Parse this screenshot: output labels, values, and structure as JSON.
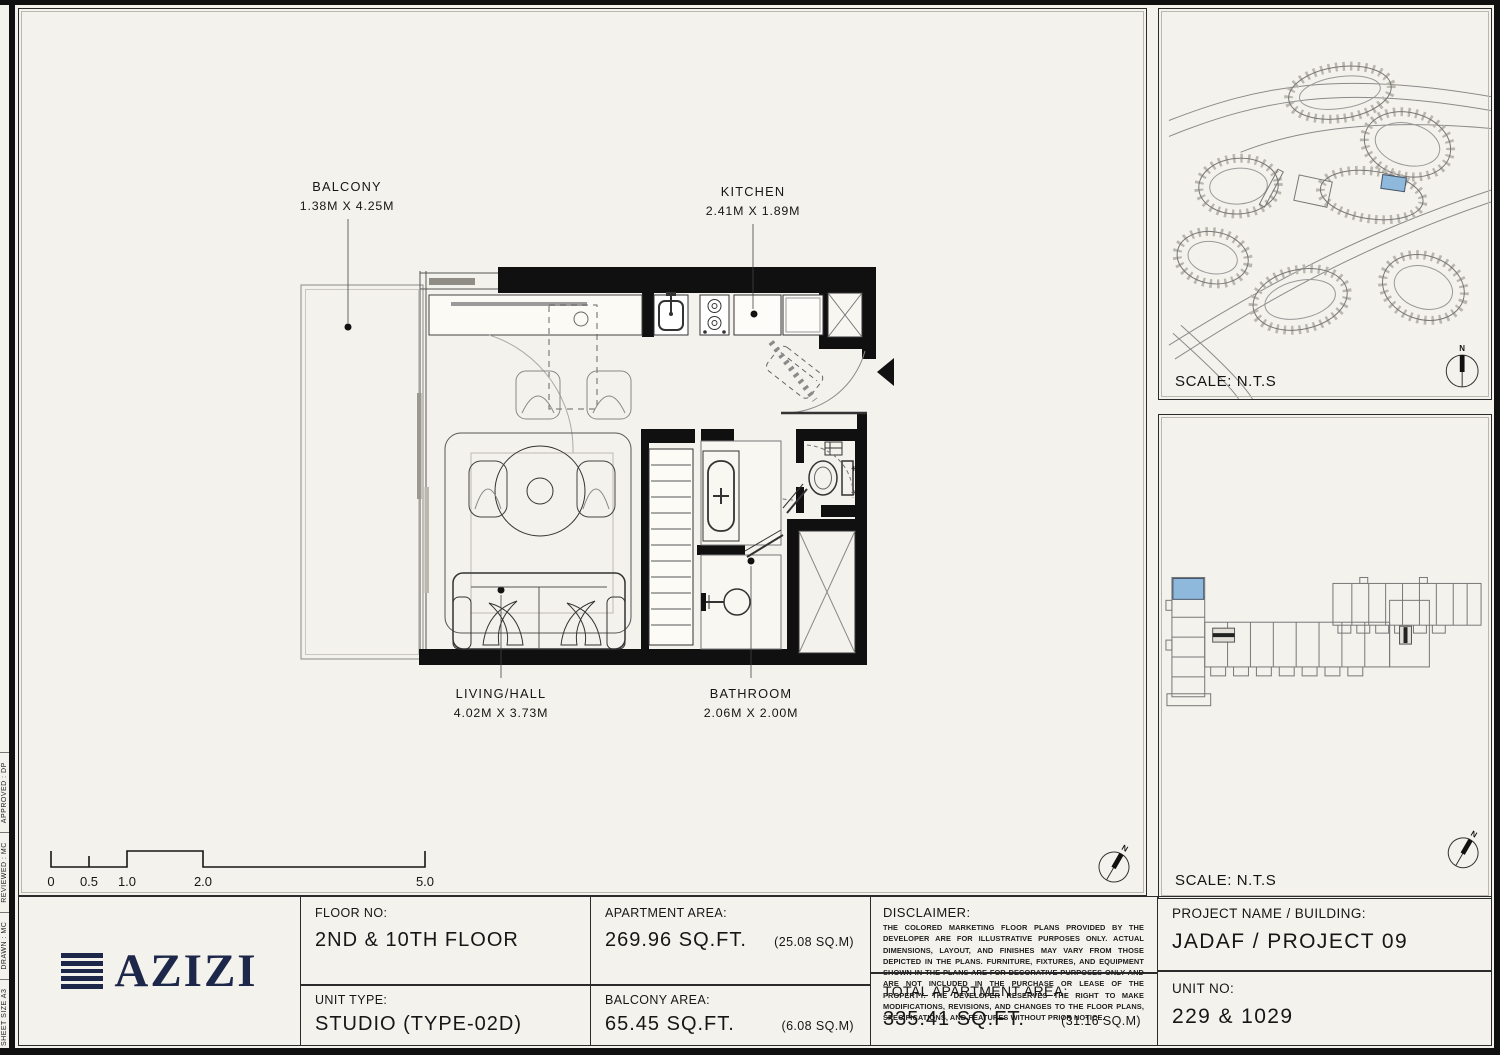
{
  "sheet": {
    "margin_notes": [
      "SHEET SIZE A3",
      "DRAWN :   MC",
      "REVIEWED :   MC",
      "APPROVED :   DP"
    ]
  },
  "plan": {
    "rooms": [
      {
        "name": "BALCONY",
        "dims": "1.38M X 4.25M"
      },
      {
        "name": "KITCHEN",
        "dims": "2.41M X 1.89M"
      },
      {
        "name": "LIVING/HALL",
        "dims": "4.02M X 3.73M"
      },
      {
        "name": "BATHROOM",
        "dims": "2.06M X 2.00M"
      }
    ],
    "scale_bar": {
      "ticks": [
        "0",
        "0.5",
        "1.0",
        "2.0",
        "5.0"
      ]
    },
    "north": "N"
  },
  "site_map": {
    "scale": "SCALE: N.T.S",
    "north": "N",
    "highlight": "#8FB9DC"
  },
  "key_plan": {
    "scale": "SCALE: N.T.S",
    "north": "N",
    "highlight": "#8FB9DC"
  },
  "title_block": {
    "logo_text": "AZIZI",
    "logo_color": "#1C2749",
    "floor_label": "FLOOR NO:",
    "floor_value": "2ND & 10TH FLOOR",
    "unit_type_label": "UNIT TYPE:",
    "unit_type_value": "STUDIO (TYPE-02D)",
    "apartment_area_label": "APARTMENT AREA:",
    "apartment_area_value": "269.96 SQ.FT.",
    "apartment_area_metric": "(25.08 SQ.M)",
    "balcony_area_label": "BALCONY AREA:",
    "balcony_area_value": "65.45 SQ.FT.",
    "balcony_area_metric": "(6.08 SQ.M)",
    "disclaimer_label": "DISCLAIMER:",
    "disclaimer_text": "THE COLORED MARKETING FLOOR PLANS PROVIDED BY THE DEVELOPER ARE FOR ILLUSTRATIVE PURPOSES ONLY. ACTUAL DIMENSIONS, LAYOUT, AND FINISHES MAY VARY FROM THOSE DEPICTED IN THE PLANS. FURNITURE, FIXTURES, AND EQUIPMENT SHOWN IN THE PLANS ARE FOR DECORATIVE PURPOSES ONLY AND ARE NOT INCLUDED IN THE PURCHASE OR LEASE OF THE PROPERTY. THE DEVELOPER RESERVES THE RIGHT TO MAKE MODIFICATIONS, REVISIONS, AND CHANGES TO THE FLOOR PLANS, SPECIFICATIONS, AND FEATURES WITHOUT PRIOR NOTICE.",
    "total_area_label": "TOTAL APARTMENT AREA:",
    "total_area_value": "335.41 SQ.FT.",
    "total_area_metric": "(31.16 SQ.M)",
    "project_label": "PROJECT NAME / BUILDING:",
    "project_value": "JADAF / PROJECT 09",
    "unit_no_label": "UNIT NO:",
    "unit_no_value": "229 & 1029"
  }
}
